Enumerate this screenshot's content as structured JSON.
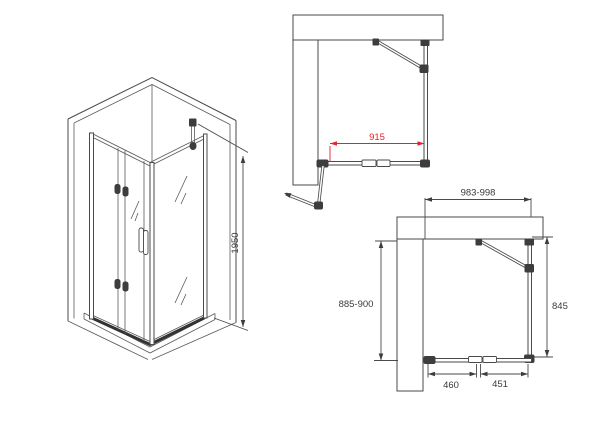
{
  "drawing": {
    "type": "shower-enclosure-technical-drawing",
    "views": {
      "isometric": {
        "description": "corner shower enclosure with bi-fold door",
        "height": "1950"
      },
      "plan_open": {
        "opening_width": "915"
      },
      "plan_closed": {
        "total_width": "983-998",
        "depth": "885-900",
        "side_panel_depth": "845",
        "front_segment_left": "460",
        "front_segment_right": "451"
      }
    },
    "colors": {
      "background": "#ffffff",
      "line": "#4a4a4a",
      "fitting": "#3d3d3d",
      "dimension_black": "#3a3a3a",
      "dimension_red": "#e8212b"
    }
  }
}
